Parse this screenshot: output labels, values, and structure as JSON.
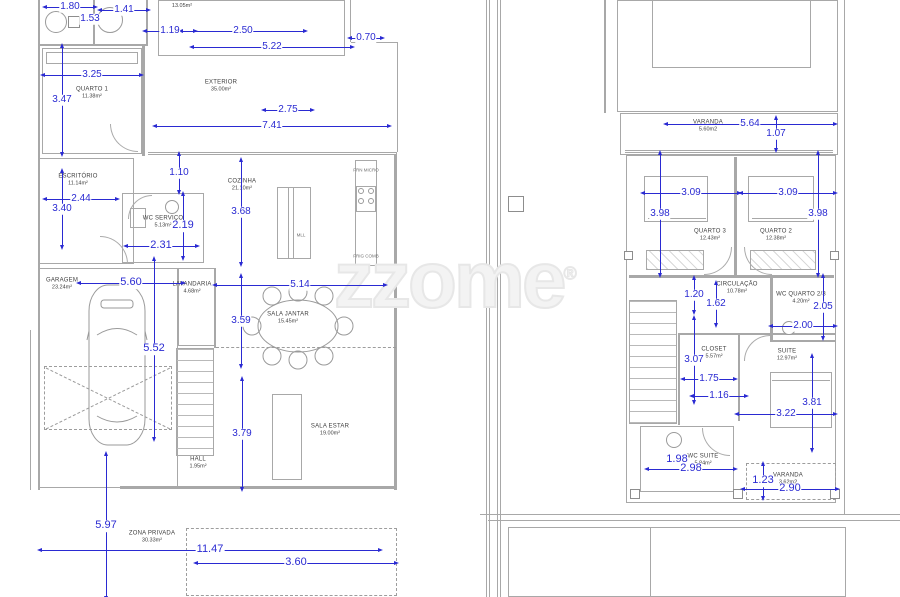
{
  "watermark": {
    "text": "zzome",
    "reg": "®"
  },
  "colors": {
    "dimension": "#2a2ad2",
    "wall": "#a8a8a8",
    "room_label": "#3f3f3f",
    "watermark": "#ededed"
  },
  "ground_floor": {
    "rooms": [
      {
        "n": "",
        "a": "13.05m²",
        "x": 182,
        "y": 6
      },
      {
        "n": "QUARTO 1",
        "a": "11.38m²",
        "x": 92,
        "y": 93
      },
      {
        "n": "EXTERIOR",
        "a": "35.00m²",
        "x": 221,
        "y": 86
      },
      {
        "n": "ESCRITÓRIO",
        "a": "11.14m²",
        "x": 78,
        "y": 180
      },
      {
        "n": "COZINHA",
        "a": "21.10m²",
        "x": 242,
        "y": 185
      },
      {
        "n": "WC SERVIÇO",
        "a": "5.13m²",
        "x": 163,
        "y": 222
      },
      {
        "n": "GARAGEM",
        "a": "23.24m²",
        "x": 62,
        "y": 284
      },
      {
        "n": "LAVANDARIA",
        "a": "4.68m²",
        "x": 192,
        "y": 288
      },
      {
        "n": "SALA JANTAR",
        "a": "15.45m²",
        "x": 288,
        "y": 318
      },
      {
        "n": "HALL",
        "a": "1.95m²",
        "x": 198,
        "y": 463
      },
      {
        "n": "SALA ESTAR",
        "a": "19.00m²",
        "x": 330,
        "y": 430
      },
      {
        "n": "ZONA PRIVADA",
        "a": "30.33m²",
        "x": 152,
        "y": 537
      }
    ],
    "fixtures": [
      {
        "t": "FRN MICRO",
        "x": 366,
        "y": 171
      },
      {
        "t": "FRIG COMB",
        "x": 366,
        "y": 257
      },
      {
        "t": "MLL",
        "x": 301,
        "y": 236
      }
    ],
    "dimensions": [
      {
        "t": "1.80",
        "x": 70,
        "y": 7,
        "o": "h",
        "l": 46
      },
      {
        "t": "1.53",
        "x": 90,
        "y": 19,
        "o": "h",
        "l": 0
      },
      {
        "t": "1.41",
        "x": 124,
        "y": 10,
        "o": "h",
        "l": 44
      },
      {
        "t": "1.19",
        "x": 170,
        "y": 31,
        "o": "h",
        "l": 46
      },
      {
        "t": "2.50",
        "x": 243,
        "y": 31,
        "o": "h",
        "l": 120
      },
      {
        "t": "5.22",
        "x": 272,
        "y": 47,
        "o": "h",
        "l": 156
      },
      {
        "t": "0.70",
        "x": 366,
        "y": 38,
        "o": "h",
        "l": 28
      },
      {
        "t": "3.25",
        "x": 92,
        "y": 75,
        "o": "h",
        "l": 94
      },
      {
        "t": "3.47",
        "x": 62,
        "y": 100,
        "o": "v",
        "l": 104
      },
      {
        "t": "2.75",
        "x": 288,
        "y": 110,
        "o": "h",
        "l": 44
      },
      {
        "t": "7.41",
        "x": 272,
        "y": 126,
        "o": "h",
        "l": 230
      },
      {
        "t": "1.10",
        "x": 179,
        "y": 173,
        "o": "v",
        "l": 34
      },
      {
        "t": "2.44",
        "x": 81,
        "y": 199,
        "o": "h",
        "l": 68
      },
      {
        "t": "3.40",
        "x": 62,
        "y": 209,
        "o": "v",
        "l": 72
      },
      {
        "t": "2.19",
        "x": 183,
        "y": 226,
        "o": "v",
        "l": 60,
        "s": 11
      },
      {
        "t": "2.31",
        "x": 161,
        "y": 246,
        "o": "h",
        "l": 67,
        "s": 11
      },
      {
        "t": "3.68",
        "x": 241,
        "y": 212,
        "o": "v",
        "l": 100
      },
      {
        "t": "5.60",
        "x": 131,
        "y": 283,
        "o": "h",
        "l": 100,
        "s": 11
      },
      {
        "t": "5.52",
        "x": 154,
        "y": 349,
        "o": "v",
        "l": 176,
        "s": 11
      },
      {
        "t": "3.59",
        "x": 241,
        "y": 321,
        "o": "v",
        "l": 86
      },
      {
        "t": "5.14",
        "x": 300,
        "y": 285,
        "o": "h",
        "l": 166
      },
      {
        "t": "3.79",
        "x": 242,
        "y": 434,
        "o": "v",
        "l": 106
      },
      {
        "t": "5.97",
        "x": 106,
        "y": 526,
        "o": "v",
        "l": 140,
        "s": 11
      },
      {
        "t": "11.47",
        "x": 210,
        "y": 550,
        "o": "h",
        "l": 336,
        "s": 11
      },
      {
        "t": "3.60",
        "x": 296,
        "y": 563,
        "o": "h",
        "l": 196,
        "s": 11
      }
    ]
  },
  "upper_floor": {
    "rooms": [
      {
        "n": "VARANDA",
        "a": "5.60m2",
        "x": 708,
        "y": 126
      },
      {
        "n": "QUARTO 3",
        "a": "12.43m²",
        "x": 710,
        "y": 235
      },
      {
        "n": "QUARTO 2",
        "a": "12.38m²",
        "x": 776,
        "y": 235
      },
      {
        "n": "CIRCULAÇÃO",
        "a": "10.78m²",
        "x": 737,
        "y": 288
      },
      {
        "n": "WC QUARTO 2/3",
        "a": "4.20m²",
        "x": 801,
        "y": 298
      },
      {
        "n": "CLOSET",
        "a": "5.57m²",
        "x": 714,
        "y": 353
      },
      {
        "n": "SUITE",
        "a": "12.97m²",
        "x": 787,
        "y": 355
      },
      {
        "n": "WC SUITE",
        "a": "5.84m²",
        "x": 703,
        "y": 460
      },
      {
        "n": "VARANDA",
        "a": "3.62m2",
        "x": 788,
        "y": 479
      }
    ],
    "fixtures": [],
    "dimensions": [
      {
        "t": "5.64",
        "x": 750,
        "y": 124,
        "o": "h",
        "l": 165
      },
      {
        "t": "1.07",
        "x": 776,
        "y": 134,
        "o": "v",
        "l": 28
      },
      {
        "t": "3.09",
        "x": 691,
        "y": 193,
        "o": "h",
        "l": 92
      },
      {
        "t": "3.98",
        "x": 660,
        "y": 214,
        "o": "v",
        "l": 118
      },
      {
        "t": "3.09",
        "x": 788,
        "y": 193,
        "o": "h",
        "l": 90
      },
      {
        "t": "3.98",
        "x": 818,
        "y": 214,
        "o": "v",
        "l": 118
      },
      {
        "t": "1.20",
        "x": 694,
        "y": 295,
        "o": "v",
        "l": 30
      },
      {
        "t": "1.62",
        "x": 716,
        "y": 304,
        "o": "v",
        "l": 38
      },
      {
        "t": "2.05",
        "x": 823,
        "y": 307,
        "o": "v",
        "l": 58
      },
      {
        "t": "2.00",
        "x": 803,
        "y": 326,
        "o": "h",
        "l": 60
      },
      {
        "t": "3.07",
        "x": 694,
        "y": 360,
        "o": "v",
        "l": 80
      },
      {
        "t": "1.75",
        "x": 709,
        "y": 379,
        "o": "h",
        "l": 48
      },
      {
        "t": "1.16",
        "x": 719,
        "y": 396,
        "o": "h",
        "l": 50
      },
      {
        "t": "3.81",
        "x": 812,
        "y": 403,
        "o": "v",
        "l": 90
      },
      {
        "t": "3.22",
        "x": 786,
        "y": 414,
        "o": "h",
        "l": 94
      },
      {
        "t": "1.98",
        "x": 677,
        "y": 460,
        "o": "h",
        "l": 0,
        "s": 11
      },
      {
        "t": "2.98",
        "x": 691,
        "y": 469,
        "o": "h",
        "l": 84,
        "s": 11
      },
      {
        "t": "1.23",
        "x": 763,
        "y": 481,
        "o": "v",
        "l": 30,
        "s": 11
      },
      {
        "t": "2.90",
        "x": 790,
        "y": 489,
        "o": "h",
        "l": 90,
        "s": 11
      }
    ]
  }
}
